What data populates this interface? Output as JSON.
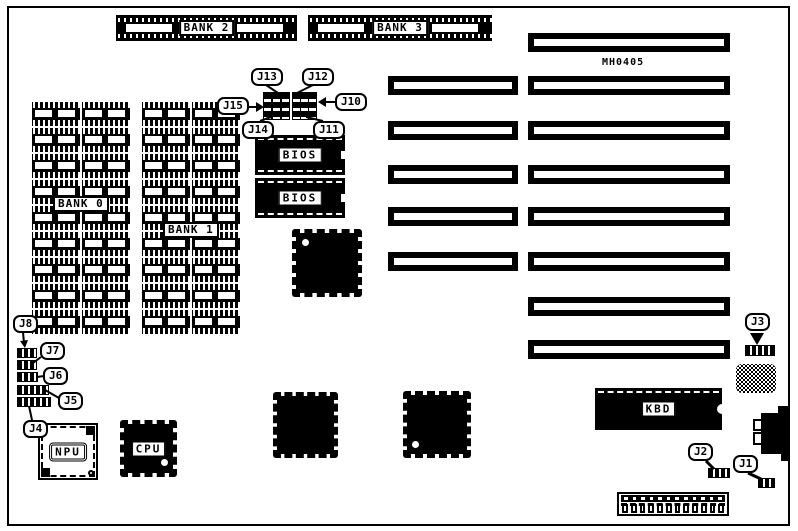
{
  "diagram": {
    "model_text": "MH0405",
    "colors": {
      "ink": "#000000",
      "paper": "#ffffff"
    }
  },
  "memory": {
    "simm_sockets": [
      {
        "label": "BANK 2"
      },
      {
        "label": "BANK 3"
      }
    ],
    "dip_banks": [
      {
        "label": "BANK 0"
      },
      {
        "label": "BANK 1"
      }
    ],
    "dip_columns": 4,
    "dip_rows_per_column": 9
  },
  "chips": {
    "bios": [
      {
        "label": "BIOS"
      },
      {
        "label": "BIOS"
      }
    ],
    "cpu": {
      "label": "CPU"
    },
    "npu": {
      "label": "NPU"
    },
    "kbd": {
      "label": "KBD"
    }
  },
  "jumpers": {
    "j1": {
      "label": "J1"
    },
    "j2": {
      "label": "J2"
    },
    "j3": {
      "label": "J3"
    },
    "j4": {
      "label": "J4"
    },
    "j5": {
      "label": "J5"
    },
    "j6": {
      "label": "J6"
    },
    "j7": {
      "label": "J7"
    },
    "j8": {
      "label": "J8"
    },
    "j10": {
      "label": "J10"
    },
    "j11": {
      "label": "J11"
    },
    "j12": {
      "label": "J12"
    },
    "j13": {
      "label": "J13"
    },
    "j14": {
      "label": "J14"
    },
    "j15": {
      "label": "J15"
    }
  },
  "expansion_slots": {
    "paired_rows": 5,
    "long_only_rows": 3
  },
  "power_connector": {
    "pin_count": 12
  }
}
